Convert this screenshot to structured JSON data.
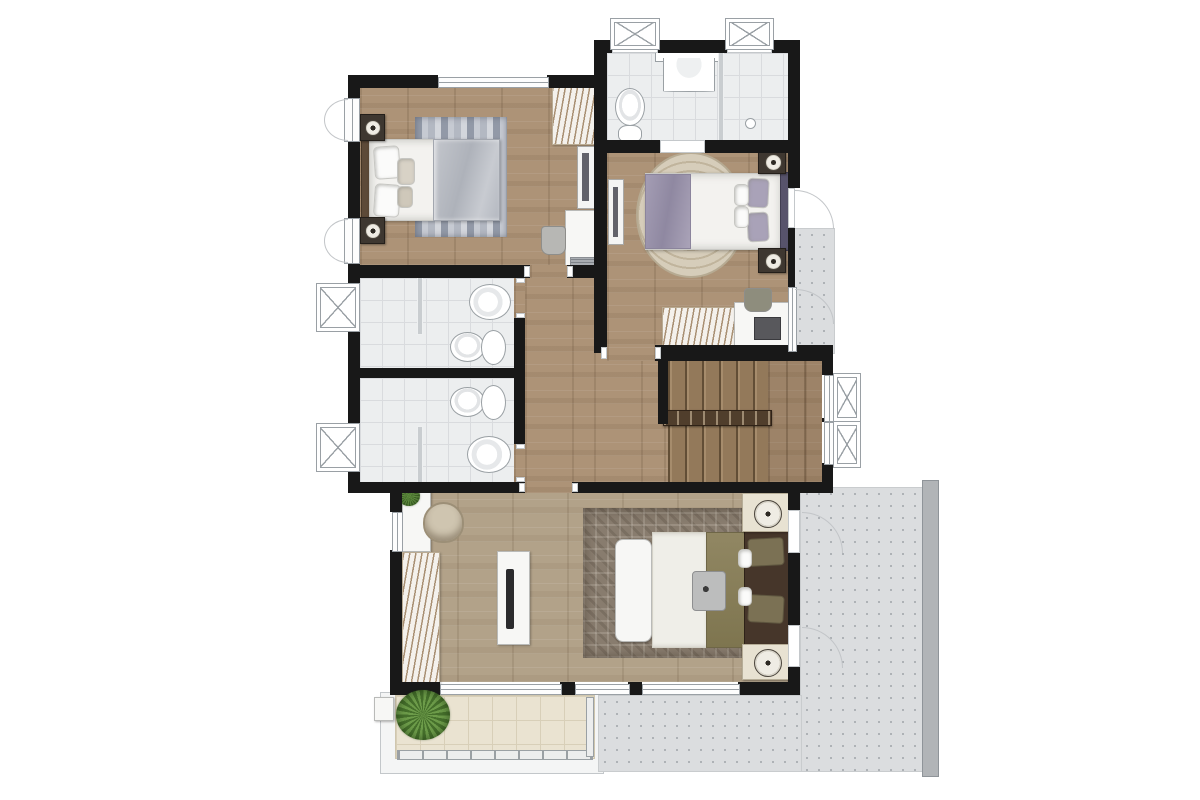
{
  "scene": {
    "type": "floor-plan",
    "rooms": [
      "bedroom-1",
      "shared-bathroom",
      "bedroom-2",
      "bathroom-a",
      "bathroom-b",
      "hallway",
      "staircase",
      "master-bedroom",
      "balcony",
      "terrace",
      "side-ledge"
    ],
    "fixtures": [
      "bed",
      "nightstand",
      "table-lamp",
      "wardrobe",
      "desk",
      "chair",
      "mirror",
      "toilet",
      "sink",
      "shower-partition",
      "tv-console",
      "bench",
      "rug",
      "tray",
      "laptop",
      "plant",
      "railing",
      "casement-window",
      "skylight-window",
      "door-swing"
    ]
  },
  "theme": {
    "wall": "#181818",
    "wood": "#ad9377",
    "wood2": "#b2a289",
    "tile": "#eceeef",
    "tile_line": "#d9dbde",
    "terrace": "#dbdddf",
    "terrace_dot": "#a7abaf",
    "terrace_edge": "#b1b4b7",
    "balcony": "#eae3d1",
    "balcony_line": "#d8cfb8",
    "curb": "#f4f5f5",
    "rug1a": "#9299a7",
    "rug1b": "#c6cad2",
    "rug2": "#d6cdba",
    "rug2_ring": "#c0b49c",
    "rugm": "#887c6e",
    "stairs": "#93795a",
    "rail": "#503e2c",
    "frame": "#9aa0a5",
    "arc": "#c2c5c8",
    "glass": "#c9cdd0",
    "fixline": "#9aa0a4",
    "plant1": "#46702c",
    "plant2": "#6d9c4a"
  }
}
